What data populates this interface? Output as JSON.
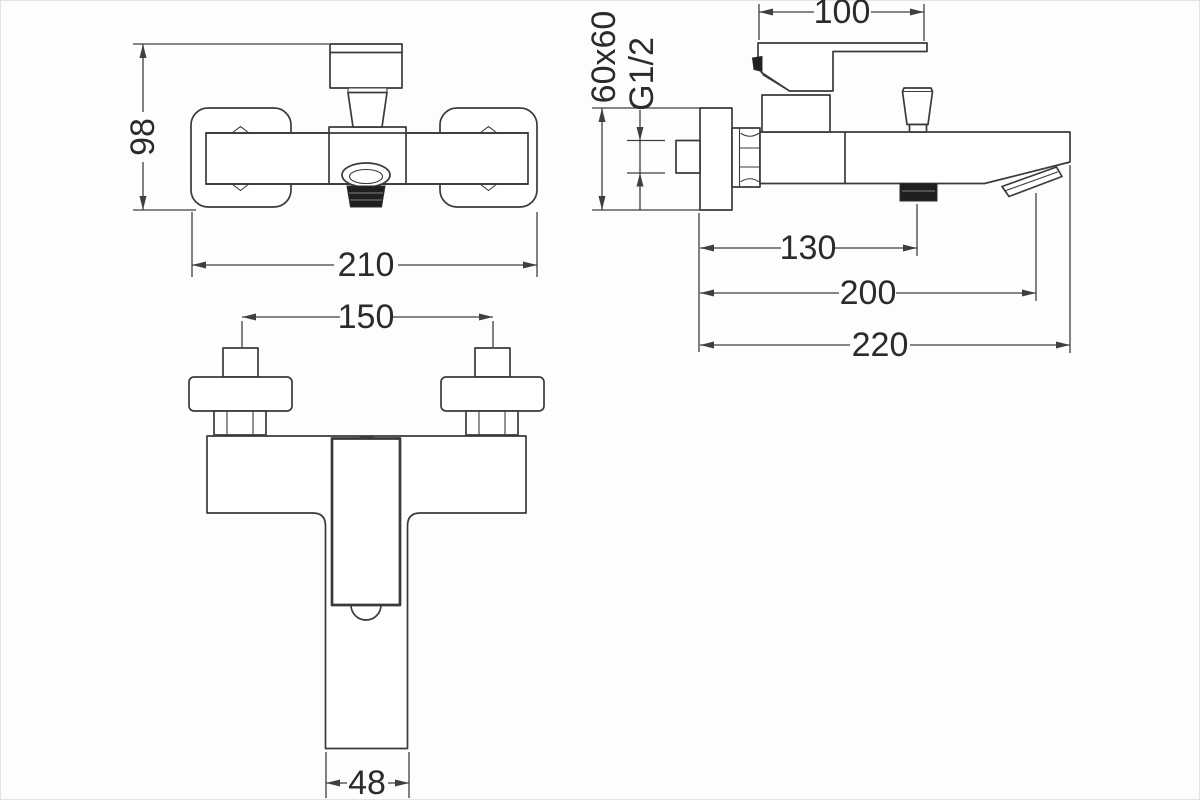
{
  "drawing": {
    "type": "technical-drawing",
    "subject": "wall-mounted bath mixer faucet, three orthographic views",
    "views": {
      "front": "front view",
      "side": "side view",
      "top": "top view"
    }
  },
  "dimensions": {
    "front_height": "98",
    "front_width": "210",
    "handle_length": "100",
    "wall_plate_size": "60x60",
    "thread_size": "G1/2",
    "wall_to_shower_outlet": "130",
    "wall_to_spout_outlet": "200",
    "total_depth": "220",
    "inlet_centers": "150",
    "spout_width": "48"
  },
  "colors": {
    "background": "#fdfdfd",
    "line": "#3a3a3a",
    "dimension_line": "#3f3f3f",
    "text": "#2b2b2b",
    "dark_fill": "#1f1f1f"
  }
}
